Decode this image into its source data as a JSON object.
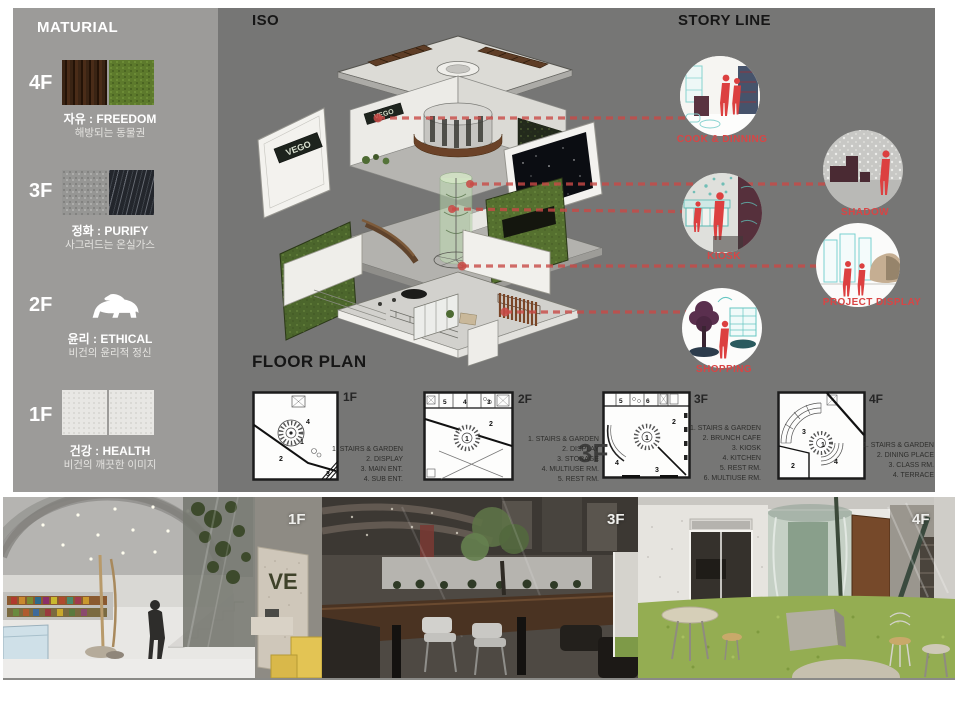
{
  "colors": {
    "page_bg": "#ffffff",
    "panel_bg": "#767675",
    "sidebar_bg": "#9c9b99",
    "accent_red": "#d84545"
  },
  "sidebar": {
    "title": "MATURIAL",
    "floors": [
      {
        "label": "4F",
        "name": "자유 : FREEDOM",
        "caption": "해방되는 동물권"
      },
      {
        "label": "3F",
        "name": "정화 : PURIFY",
        "caption": "사그러드는 온실가스"
      },
      {
        "label": "2F",
        "name": "윤리 : ETHICAL",
        "caption": "비건의 윤리적 정신",
        "icon": "polar-bear-icon"
      },
      {
        "label": "1F",
        "name": "건강 : HEALTH",
        "caption": "비건의 깨끗한 이미지"
      }
    ]
  },
  "iso": {
    "title": "ISO",
    "sign": "VEGO"
  },
  "storyline": {
    "title": "STORY LINE",
    "items": [
      {
        "label": "COOK & DINNING"
      },
      {
        "label": "SHADOW"
      },
      {
        "label": "KIOSK"
      },
      {
        "label": "PROJECT DISPLAY"
      },
      {
        "label": "SHOPPING"
      }
    ]
  },
  "floorplan": {
    "title": "FLOOR PLAN",
    "section_label": "3F",
    "plans": [
      {
        "label": "1F",
        "rooms": [
          "1",
          "2",
          "3",
          "4"
        ],
        "legend": [
          "1. STAIRS & GARDEN",
          "2. DISPLAY",
          "3. MAIN ENT.",
          "4. SUB ENT."
        ]
      },
      {
        "label": "2F",
        "rooms": [
          "1",
          "2",
          "3",
          "4",
          "5"
        ],
        "legend": [
          "1. STAIRS & GARDEN",
          "2. DISPLAY",
          "3. STORAGE",
          "4. MULTIUSE RM.",
          "5. REST RM."
        ]
      },
      {
        "label": "3F",
        "rooms": [
          "1",
          "2",
          "3",
          "4",
          "5",
          "6"
        ],
        "legend": [
          "1. STAIRS & GARDEN",
          "2. BRUNCH CAFE",
          "3. KIOSK",
          "4. KITCHEN",
          "5. REST RM.",
          "6. MULTIUSE RM."
        ]
      },
      {
        "label": "4F",
        "rooms": [
          "1",
          "2",
          "3",
          "4"
        ],
        "legend": [
          "1. STAIRS & GARDEN",
          "2. DINING PLACE",
          "3. CLASS RM.",
          "4. TERRACE"
        ]
      }
    ]
  },
  "photos": [
    {
      "label": "1F",
      "sign": "VE"
    },
    {
      "label": "3F"
    },
    {
      "label": "4F"
    }
  ]
}
